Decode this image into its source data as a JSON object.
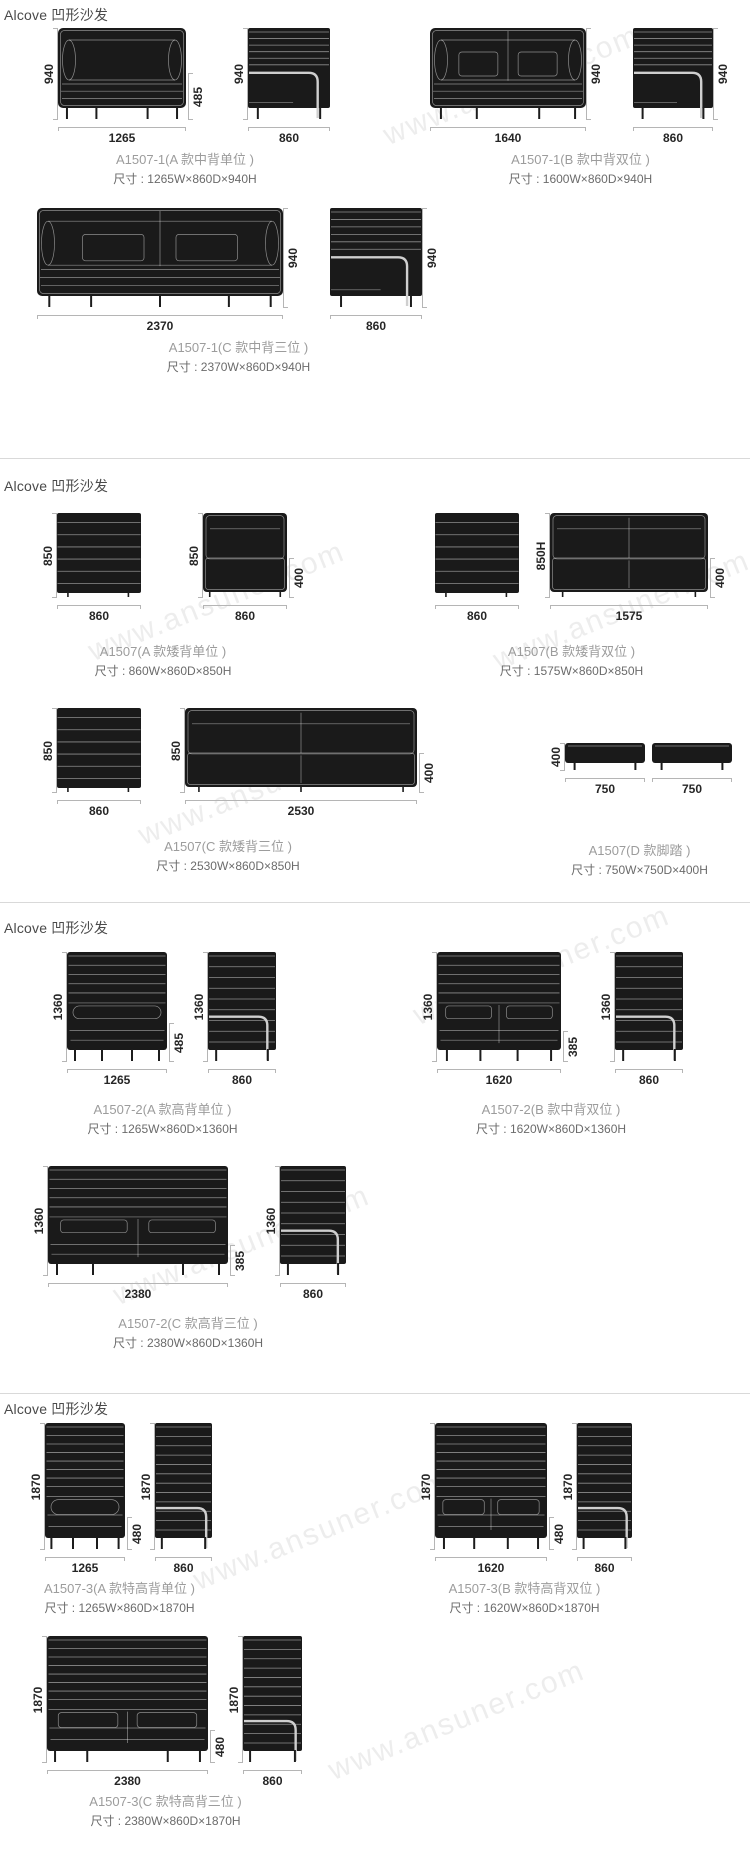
{
  "watermark": "www.ansuner.com",
  "sections": [
    {
      "header": "Alcove 凹形沙发",
      "products": [
        {
          "caption": "A1507-1(A 款中背单位 )",
          "size": "尺寸 : 1265W×860D×940H",
          "views": [
            {
              "type": "front",
              "w": "1265",
              "h": "940",
              "arm": "485"
            },
            {
              "type": "side",
              "w": "860",
              "h": "940"
            }
          ]
        },
        {
          "caption": "A1507-1(B 款中背双位 )",
          "size": "尺寸 : 1600W×860D×940H",
          "views": [
            {
              "type": "front",
              "w": "1640",
              "h": "940"
            },
            {
              "type": "side",
              "w": "860",
              "h": "940"
            }
          ]
        },
        {
          "caption": "A1507-1(C 款中背三位 )",
          "size": "尺寸 : 2370W×860D×940H",
          "views": [
            {
              "type": "front",
              "w": "2370",
              "h": "940"
            },
            {
              "type": "side",
              "w": "860",
              "h": "940"
            }
          ]
        }
      ]
    },
    {
      "header": "Alcove 凹形沙发",
      "products": [
        {
          "caption": "A1507(A 款矮背单位 )",
          "size": "尺寸 : 860W×860D×850H",
          "views": [
            {
              "type": "back-panel",
              "w": "860",
              "h": "850"
            },
            {
              "type": "front",
              "w": "860",
              "h": "850",
              "arm": "400"
            }
          ]
        },
        {
          "caption": "A1507(B 款矮背双位 )",
          "size": "尺寸 : 1575W×860D×850H",
          "views": [
            {
              "type": "back-panel",
              "w": "860"
            },
            {
              "type": "front",
              "w": "1575",
              "h": "850H",
              "arm": "400"
            }
          ]
        },
        {
          "caption": "A1507(C 款矮背三位 )",
          "size": "尺寸 : 2530W×860D×850H",
          "views": [
            {
              "type": "back-panel",
              "w": "860",
              "h": "850"
            },
            {
              "type": "front",
              "w": "2530",
              "h": "850",
              "arm": "400"
            }
          ]
        },
        {
          "caption": "A1507(D 款脚踏 )",
          "size": "尺寸 : 750W×750D×400H",
          "views": [
            {
              "type": "footstool",
              "w": "750",
              "h": "400"
            },
            {
              "type": "footstool",
              "w": "750"
            }
          ]
        }
      ]
    },
    {
      "header": "Alcove 凹形沙发",
      "products": [
        {
          "caption": "A1507-2(A 款高背单位 )",
          "size": "尺寸 : 1265W×860D×1360H",
          "views": [
            {
              "type": "front",
              "w": "1265",
              "h": "1360",
              "arm": "485"
            },
            {
              "type": "side",
              "w": "860",
              "h": "1360"
            }
          ]
        },
        {
          "caption": "A1507-2(B 款中背双位 )",
          "size": "尺寸 : 1620W×860D×1360H",
          "views": [
            {
              "type": "front",
              "w": "1620",
              "h": "1360",
              "arm": "385"
            },
            {
              "type": "side",
              "w": "860",
              "h": "1360"
            }
          ]
        },
        {
          "caption": "A1507-2(C 款高背三位 )",
          "size": "尺寸 : 2380W×860D×1360H",
          "views": [
            {
              "type": "front",
              "w": "2380",
              "h": "1360",
              "arm": "385"
            },
            {
              "type": "side",
              "w": "860",
              "h": "1360"
            }
          ]
        }
      ]
    },
    {
      "header": "Alcove 凹形沙发",
      "products": [
        {
          "caption": "A1507-3(A 款特高背单位 )",
          "size": "尺寸 : 1265W×860D×1870H",
          "views": [
            {
              "type": "front",
              "w": "1265",
              "h": "1870",
              "arm": "480"
            },
            {
              "type": "side",
              "w": "860",
              "h": "1870"
            }
          ]
        },
        {
          "caption": "A1507-3(B 款特高背双位 )",
          "size": "尺寸 : 1620W×860D×1870H",
          "views": [
            {
              "type": "front",
              "w": "1620",
              "h": "1870",
              "arm": "480"
            },
            {
              "type": "side",
              "w": "860",
              "h": "1870"
            }
          ]
        },
        {
          "caption": "A1507-3(C 款特高背三位 )",
          "size": "尺寸 : 2380W×860D×1870H",
          "views": [
            {
              "type": "front",
              "w": "2380",
              "h": "1870",
              "arm": "480"
            },
            {
              "type": "side",
              "w": "860",
              "h": "1870"
            }
          ]
        }
      ]
    }
  ]
}
